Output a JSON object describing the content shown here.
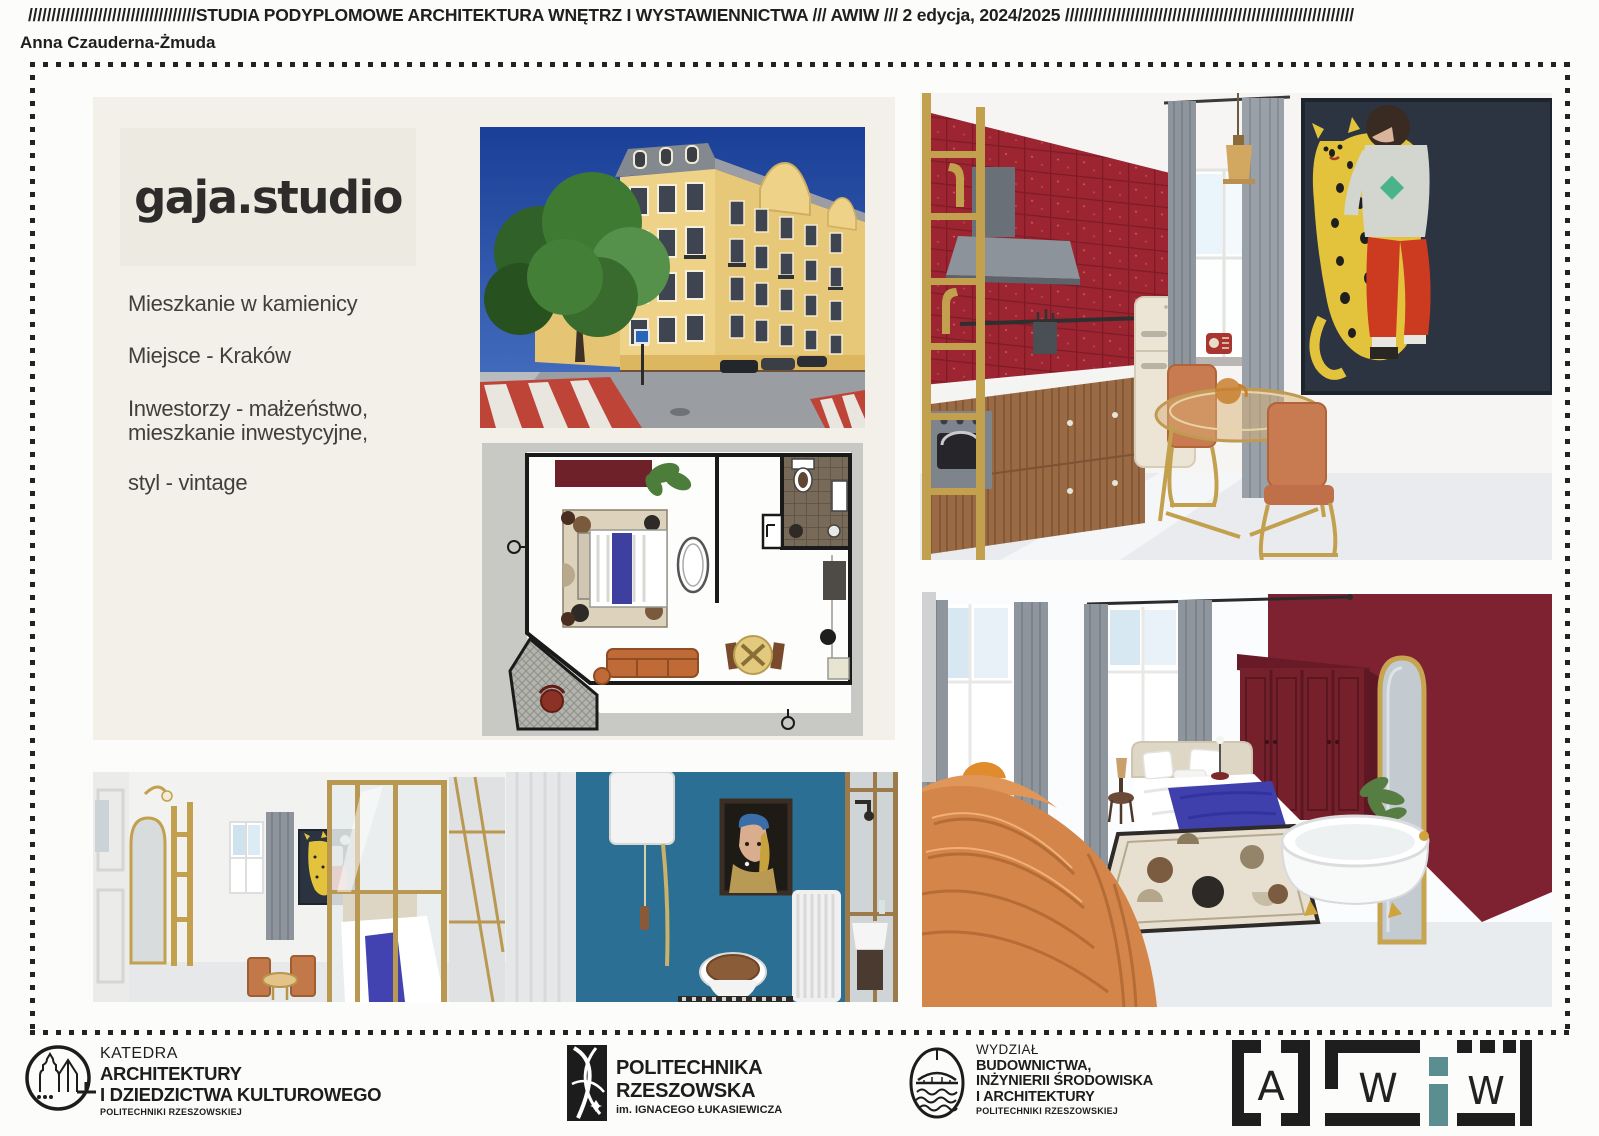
{
  "header": {
    "strip": "////////////////////////////////////STUDIA PODYPLOMOWE ARCHITEKTURA WNĘTRZ I WYSTAWIENNICTWA /// AWIW /// 2 edycja, 2024/2025 //////////////////////////////////////////////////////////////",
    "author": "Anna Czauderna-Żmuda"
  },
  "project": {
    "studio": "gaja.studio",
    "line1": "Mieszkanie w kamienicy",
    "line2": "Miejsce - Kraków",
    "line3a": "Inwestorzy - małżeństwo,",
    "line3b": "mieszkanie inwestycyjne,",
    "line4": "styl - vintage"
  },
  "footer": {
    "katedra_l1": "KATEDRA",
    "katedra_l2": "ARCHITEKTURY",
    "katedra_l3": "I DZIEDZICTWA KULTUROWEGO",
    "katedra_sub": "POLITECHNIKI RZESZOWSKIEJ",
    "pol_l1": "POLITECHNIKA",
    "pol_l2": "RZESZOWSKA",
    "pol_sub": "im. IGNACEGO ŁUKASIEWICZA",
    "wydz_l1": "WYDZIAŁ",
    "wydz_l2": "BUDOWNICTWA,",
    "wydz_l3": "INŻYNIERII ŚRODOWISKA",
    "wydz_l4": "I ARCHITEKTURY",
    "wydz_sub": "POLITECHNIKI RZESZOWSKIEJ",
    "awiw_a": "A",
    "awiw_w1": "W",
    "awiw_i": "i",
    "awiw_w2": "W"
  },
  "colors": {
    "tile_red": "#9c2531",
    "maroon": "#7b2130",
    "gold": "#c2a04e",
    "awiw_teal": "#5a8e90",
    "bathroom_blue": "#2d7095",
    "sofa_orange": "#d4854a"
  }
}
